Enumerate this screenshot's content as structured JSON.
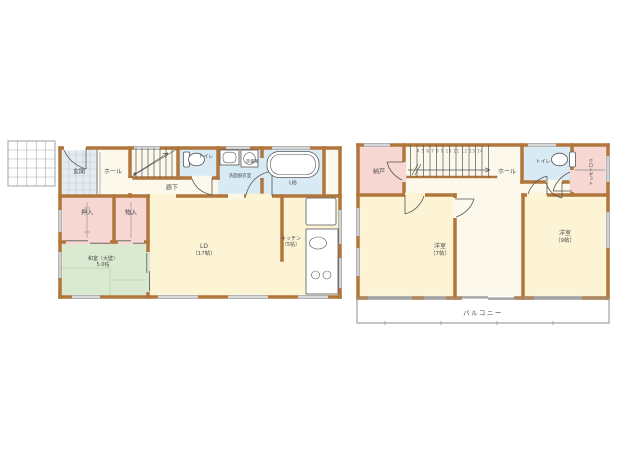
{
  "floor1": {
    "entrance": "玄関",
    "hall": "ホール",
    "corridor": "廊下",
    "toilet": "トイレ",
    "washroom": "洗面脱衣室",
    "washer": "洗濯機",
    "bath": "UB",
    "closet_oshiire": "押入",
    "closet_monoire": "物入",
    "japanese_room": {
      "name": "和室（大壁）",
      "size": "5.0帖"
    },
    "living_dining": {
      "name": "LD",
      "size": "（17帖）"
    },
    "kitchen": {
      "name": "キッチン",
      "size": "（5帖）"
    }
  },
  "floor2": {
    "storeroom": "納戸",
    "hall": "ホール",
    "toilet": "トイレ",
    "closet": "クローゼット",
    "bedroom1": {
      "name": "洋室",
      "size": "（7帖）"
    },
    "bedroom2": {
      "name": "洋室",
      "size": "（9帖）"
    },
    "balcony": "バルコニー",
    "stair_numbers": "4 5 6 7 8 9 10 11 12 13 14"
  },
  "colors": {
    "wall": "#b1763c",
    "floor_cream": "#fdf4d6",
    "floor_pale": "#fcf9ec",
    "wet_blue": "#d8eaf4",
    "closet_pink": "#f6d7d2",
    "tatami_green": "#d9ead0",
    "entrance_tile": "#e4ecf2",
    "line": "#555555"
  }
}
